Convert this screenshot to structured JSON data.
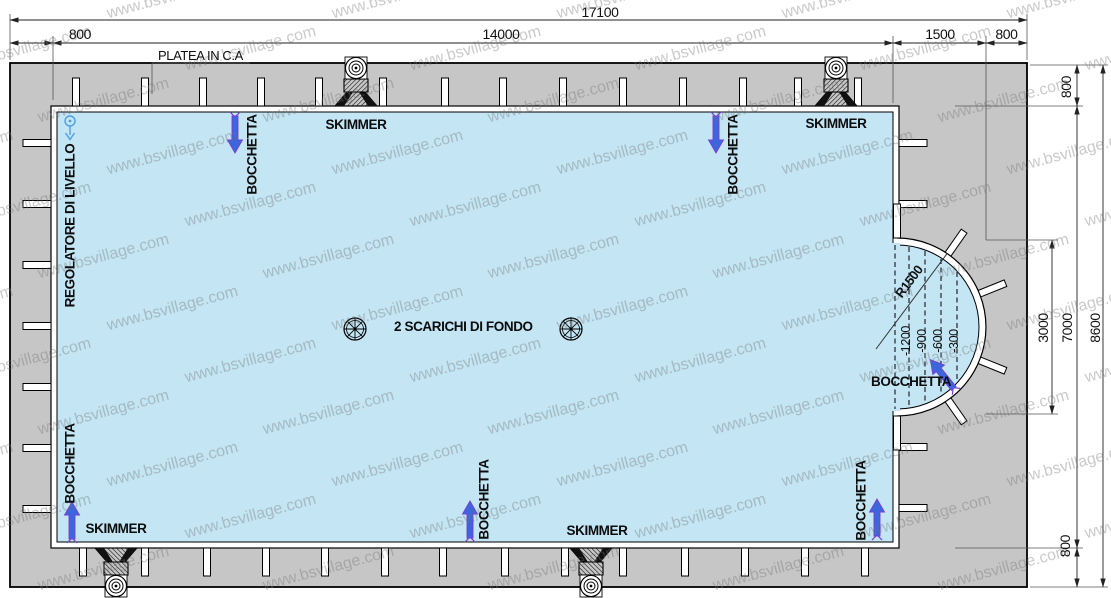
{
  "watermark": {
    "text": "www.bsvillage.com"
  },
  "labels": {
    "platea": "PLATEA IN C.A",
    "regolatore_di_livello": "REGOLATORE DI LIVELLO",
    "skimmer": "SKIMMER",
    "bocchetta": "BOCCHETTA",
    "scarichi_di_fondo": "2 SCARICHI DI FONDO",
    "stair_radius": "R1500",
    "depth_markers": [
      "-1200",
      "-900",
      "-600",
      "-300"
    ]
  },
  "dimensions_mm": {
    "overall_width": "17100",
    "margin_left": "800",
    "pool_width": "14000",
    "stair_extension": "1500",
    "margin_right": "800",
    "margin_top": "800",
    "stair_opening_height": "3000",
    "pool_height": "7000",
    "overall_height": "8600",
    "margin_bottom": "800"
  },
  "colors": {
    "slab_gray": "#c6c6c6",
    "water_blue": "#c3e5f4",
    "wall_white": "#ffffff",
    "line_black": "#1a1a1a",
    "arrow_blue": "#3d66dd",
    "arrow_violet": "#7a3bd6",
    "regolatore_blue": "#4b9fe8",
    "watermark_gray": "#737373"
  }
}
